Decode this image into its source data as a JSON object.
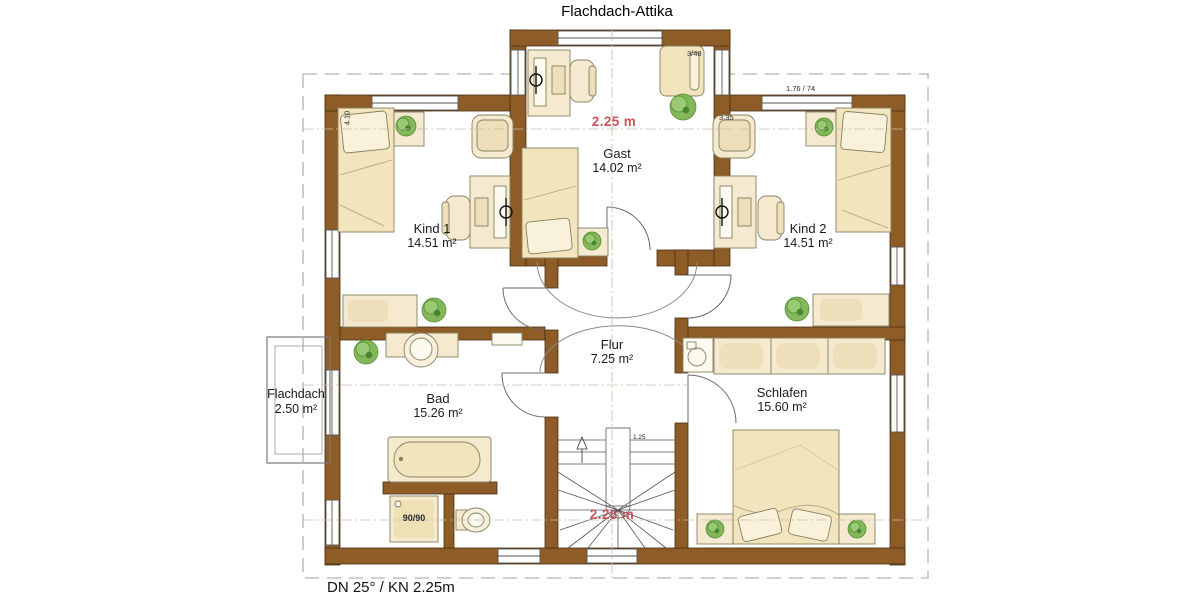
{
  "title": "Flachdach-Attika",
  "footer": "DN 25° / KN 2.25m",
  "rooms": [
    {
      "id": "gast",
      "name": "Gast",
      "area": "14.02 m²"
    },
    {
      "id": "kind1",
      "name": "Kind 1",
      "area": "14.51 m²"
    },
    {
      "id": "kind2",
      "name": "Kind 2",
      "area": "14.51 m²"
    },
    {
      "id": "flur",
      "name": "Flur",
      "area": "7.25 m²"
    },
    {
      "id": "bad",
      "name": "Bad",
      "area": "15.26 m²"
    },
    {
      "id": "schlafen",
      "name": "Schlafen",
      "area": "15.60 m²"
    },
    {
      "id": "flachdach",
      "name": "Flachdach",
      "area": "2.50 m²"
    }
  ],
  "annotations": {
    "ceiling_height_gast": "2.25 m",
    "ceiling_height_stairs": "2.25 m",
    "dim_left_wall": "4.10",
    "dim_gast_bed": "3/48",
    "dim_kind2_wall": "3.35",
    "dim_kind2_window": "1.76 / 74",
    "shower_size": "90/90",
    "stair_dim": "1.25"
  },
  "colors": {
    "wall": "#8e5c27",
    "accent_red": "#c4545e",
    "furniture": "#f5ead0",
    "plant": "#79ad4f"
  }
}
